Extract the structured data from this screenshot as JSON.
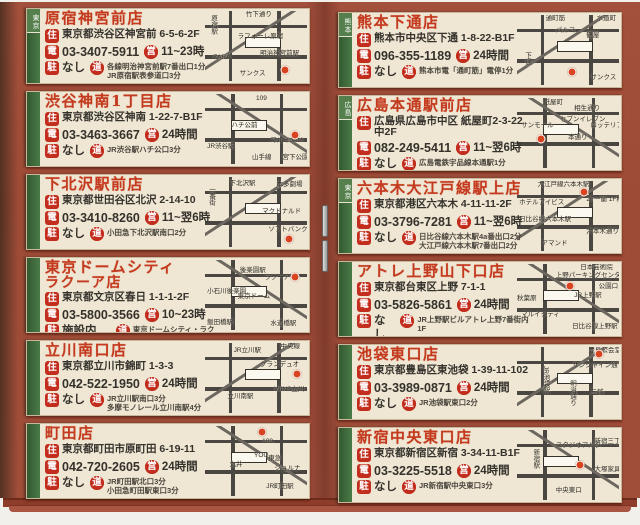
{
  "badges": {
    "address": "住",
    "phone": "電",
    "hours": "営",
    "parking": "駐",
    "access": "道"
  },
  "stores": [
    {
      "region": "東京",
      "name": "原宿神宮前店",
      "name2": "",
      "address": "東京都渋谷区神宮前 6-5-6-2F",
      "phone": "03-3407-5911",
      "hours": "11~23時",
      "parking": "なし",
      "access1": "各線明治神宮前駅7番出口1分",
      "access2": "JR原宿駅表参道口3分",
      "map": {
        "marker": {
          "x": 78,
          "y": 84
        },
        "labels": [
          {
            "t": "原宿駅",
            "x": 6,
            "y": 8,
            "v": true
          },
          {
            "t": "竹下通り",
            "x": 42,
            "y": 4
          },
          {
            "t": "ラフォーレ原宿",
            "x": 34,
            "y": 36
          },
          {
            "t": "ZARA",
            "x": 10,
            "y": 66
          },
          {
            "t": "明治神宮前駅",
            "x": 56,
            "y": 60
          },
          {
            "t": "サンクス",
            "x": 36,
            "y": 88
          }
        ]
      }
    },
    {
      "region": "",
      "name": "渋谷神南1丁目店",
      "name2": "",
      "address": "東京都渋谷区神南 1-22-7-B1F",
      "phone": "03-3463-3667",
      "hours": "24時間",
      "parking": "なし",
      "access1": "JR渋谷駅ハチ公口3分",
      "access2": "",
      "map": {
        "marker": {
          "x": 88,
          "y": 58
        },
        "labels": [
          {
            "t": "109",
            "x": 52,
            "y": 6
          },
          {
            "t": "ハチ公前",
            "x": 28,
            "y": 44
          },
          {
            "t": "マルイJAM",
            "x": 66,
            "y": 66
          },
          {
            "t": "JR渋谷駅",
            "x": 4,
            "y": 74
          },
          {
            "t": "山手線",
            "x": 48,
            "y": 90
          },
          {
            "t": "宮下公園",
            "x": 78,
            "y": 90
          }
        ]
      }
    },
    {
      "region": "",
      "name": "下北沢駅前店",
      "name2": "",
      "address": "東京都世田谷区北沢 2-14-10",
      "phone": "03-3410-8260",
      "hours": "11~翌6時",
      "parking": "なし",
      "access1": "小田急下北沢駅南口2分",
      "access2": "",
      "map": {
        "marker": {
          "x": 82,
          "y": 88
        },
        "labels": [
          {
            "t": "下北沢駅",
            "x": 26,
            "y": 8
          },
          {
            "t": "本多劇場",
            "x": 72,
            "y": 10
          },
          {
            "t": "マクドナルド",
            "x": 58,
            "y": 48
          },
          {
            "t": "ソフトバンク",
            "x": 64,
            "y": 74
          },
          {
            "t": "一番街",
            "x": 4,
            "y": 16,
            "v": true
          }
        ]
      }
    },
    {
      "region": "",
      "name": "東京ドームシティ",
      "name2": "ラクーア店",
      "address": "東京都文京区春日 1-1-1-2F",
      "phone": "03-5800-3566",
      "hours": "10~23時",
      "parking": "施設内(有料)",
      "access1": "東京ドームシティ・ラクーア内2F",
      "access2": "",
      "map": {
        "marker": {
          "x": 88,
          "y": 24
        },
        "labels": [
          {
            "t": "後楽園駅",
            "x": 36,
            "y": 14
          },
          {
            "t": "ラクーア",
            "x": 60,
            "y": 24
          },
          {
            "t": "東京ドーム",
            "x": 34,
            "y": 52
          },
          {
            "t": "小石川後楽園",
            "x": 4,
            "y": 44
          },
          {
            "t": "飯田橋駅",
            "x": 4,
            "y": 88
          },
          {
            "t": "水道橋駅",
            "x": 66,
            "y": 90
          }
        ]
      }
    },
    {
      "region": "",
      "name": "立川南口店",
      "name2": "",
      "address": "東京都立川市錦町 1-3-3",
      "phone": "042-522-1950",
      "hours": "24時間",
      "parking": "なし",
      "access1": "JR立川駅南口3分",
      "access2": "多摩モノレール立川南駅4分",
      "map": {
        "marker": {
          "x": 90,
          "y": 44
        },
        "labels": [
          {
            "t": "JR立川駅",
            "x": 30,
            "y": 10
          },
          {
            "t": "中央線",
            "x": 76,
            "y": 4
          },
          {
            "t": "グランデュオ",
            "x": 56,
            "y": 30
          },
          {
            "t": "立川南駅",
            "x": 24,
            "y": 76
          },
          {
            "t": "WINS立川",
            "x": 70,
            "y": 66
          }
        ]
      }
    },
    {
      "region": "",
      "name": "町田店",
      "name2": "",
      "address": "東京都町田市原町田 6-19-11",
      "phone": "042-720-2605",
      "hours": "24時間",
      "parking": "なし",
      "access1": "JR町田駅北口3分",
      "access2": "小田急町田駅東口3分",
      "map": {
        "marker": {
          "x": 56,
          "y": 8
        },
        "labels": [
          {
            "t": "109",
            "x": 58,
            "y": 22
          },
          {
            "t": "YOU",
            "x": 50,
            "y": 42
          },
          {
            "t": "丸井",
            "x": 26,
            "y": 54
          },
          {
            "t": "東急",
            "x": 64,
            "y": 46
          },
          {
            "t": "ジョルナ",
            "x": 70,
            "y": 60
          },
          {
            "t": "JR町田駅",
            "x": 62,
            "y": 86
          }
        ]
      }
    },
    {
      "region": "熊本",
      "name": "熊本下通店",
      "name2": "",
      "address": "熊本市中央区下通 1-8-22-B1F",
      "phone": "096-355-1189",
      "hours": "24時間",
      "parking": "なし",
      "access1": "熊本市電「通町筋」電停1分",
      "access2": "",
      "map": {
        "marker": {
          "x": 54,
          "y": 82
        },
        "labels": [
          {
            "t": "通町筋",
            "x": 30,
            "y": 4
          },
          {
            "t": "水道町",
            "x": 80,
            "y": 4
          },
          {
            "t": "パルコ",
            "x": 40,
            "y": 22
          },
          {
            "t": "鶴屋",
            "x": 70,
            "y": 28
          },
          {
            "t": "下通",
            "x": 8,
            "y": 56,
            "v": true
          },
          {
            "t": "サンクス",
            "x": 74,
            "y": 88
          }
        ]
      }
    },
    {
      "region": "広島",
      "name": "広島本通駅前店",
      "name2": "",
      "address": "広島県広島市中区 紙屋町2-3-22 中2F",
      "phone": "082-249-5411",
      "hours": "11~翌6時",
      "parking": "なし",
      "access1": "広島電鉄宇品線本通駅1分",
      "access2": "",
      "map": {
        "marker": {
          "x": 24,
          "y": 58
        },
        "labels": [
          {
            "t": "紙屋町",
            "x": 28,
            "y": 6
          },
          {
            "t": "相生通り",
            "x": 58,
            "y": 14
          },
          {
            "t": "サンモール",
            "x": 6,
            "y": 38
          },
          {
            "t": "セブンイレブン",
            "x": 44,
            "y": 30
          },
          {
            "t": "ロッテリア",
            "x": 74,
            "y": 38
          },
          {
            "t": "本通り",
            "x": 52,
            "y": 56
          }
        ]
      }
    },
    {
      "region": "東京",
      "name": "六本木大江戸線駅上店",
      "name2": "",
      "address": "東京都港区六本木 4-11-11-2F",
      "phone": "03-3796-7281",
      "hours": "11~翌6時",
      "parking": "なし",
      "access1": "日比谷線六本木駅4a番出口2分",
      "access2": "大江戸線六本木駅7番出口2分",
      "map": {
        "marker": {
          "x": 66,
          "y": 16
        },
        "labels": [
          {
            "t": "大江戸線六本木駅",
            "x": 22,
            "y": 4
          },
          {
            "t": "ホテルアイビス",
            "x": 4,
            "y": 30
          },
          {
            "t": "2F一蘭 1F松屋",
            "x": 70,
            "y": 26
          },
          {
            "t": "日比谷線六本木駅",
            "x": 4,
            "y": 54
          },
          {
            "t": "六本木通り",
            "x": 70,
            "y": 72
          },
          {
            "t": "アマンド",
            "x": 26,
            "y": 88
          }
        ]
      }
    },
    {
      "region": "",
      "name": "アトレ上野山下口店",
      "name2": "",
      "address": "東京都台東区上野 7-1-1",
      "phone": "03-5826-5861",
      "hours": "24時間",
      "parking": "なし",
      "access1": "JR上野駅ビルアトレ上野7番街内1F",
      "access2": "",
      "map": {
        "marker": {
          "x": 52,
          "y": 32
        },
        "labels": [
          {
            "t": "日本芸術院",
            "x": 64,
            "y": 4
          },
          {
            "t": "上野パーキングセンター",
            "x": 40,
            "y": 16
          },
          {
            "t": "JR上野駅",
            "x": 58,
            "y": 44
          },
          {
            "t": "公園口",
            "x": 82,
            "y": 32
          },
          {
            "t": "秋葉原",
            "x": 2,
            "y": 48
          },
          {
            "t": "マルイシティ",
            "x": 6,
            "y": 72
          },
          {
            "t": "日比谷線上野駅",
            "x": 56,
            "y": 88
          }
        ]
      }
    },
    {
      "region": "",
      "name": "池袋東口店",
      "name2": "",
      "address": "東京都豊島区東池袋 1-39-11-102",
      "phone": "03-3989-0871",
      "hours": "24時間",
      "parking": "なし",
      "access1": "JR池袋駅東口2分",
      "access2": "",
      "map": {
        "marker": {
          "x": 80,
          "y": 10
        },
        "labels": [
          {
            "t": "豊島公会堂",
            "x": 72,
            "y": 4
          },
          {
            "t": "サンシャイン通り",
            "x": 56,
            "y": 26
          },
          {
            "t": "JR池袋駅",
            "x": 26,
            "y": 30,
            "v": true
          },
          {
            "t": "明治通り",
            "x": 52,
            "y": 50,
            "v": true
          },
          {
            "t": "三越",
            "x": 74,
            "y": 64
          }
        ]
      }
    },
    {
      "region": "",
      "name": "新宿中央東口店",
      "name2": "",
      "address": "東京都新宿区新宿 3-34-11-B1F",
      "phone": "03-3225-5518",
      "hours": "24時間",
      "parking": "なし",
      "access1": "JR新宿駅中央東口3分",
      "access2": "",
      "map": {
        "marker": {
          "x": 62,
          "y": 50
        },
        "labels": [
          {
            "t": "新宿駅",
            "x": 16,
            "y": 30,
            "v": true
          },
          {
            "t": "スタジオアルタ",
            "x": 40,
            "y": 22
          },
          {
            "t": "新宿三丁目",
            "x": 78,
            "y": 16
          },
          {
            "t": "大塚家具",
            "x": 78,
            "y": 56
          },
          {
            "t": "中央東口",
            "x": 40,
            "y": 86
          }
        ]
      }
    }
  ]
}
